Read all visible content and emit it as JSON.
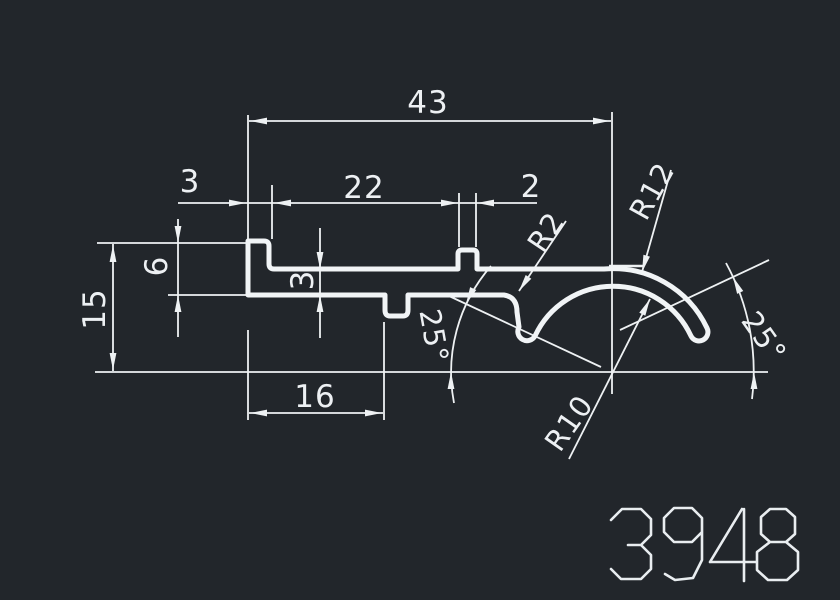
{
  "title": "CAD profile drawing 3948",
  "part_number": "3948",
  "canvas": {
    "background_color": "#22262b",
    "line_color": "#eef1f3"
  },
  "dimensions": {
    "total_width": "43",
    "step_width": "3",
    "web_length": "22",
    "bump_width": "2",
    "total_height": "15",
    "left_height": "6",
    "web_thickness": "3",
    "bottom_length": "16",
    "fillet_radius": "R2",
    "outer_radius": "R12",
    "inner_radius": "R10",
    "angle_left": "25°",
    "angle_right": "25°"
  }
}
